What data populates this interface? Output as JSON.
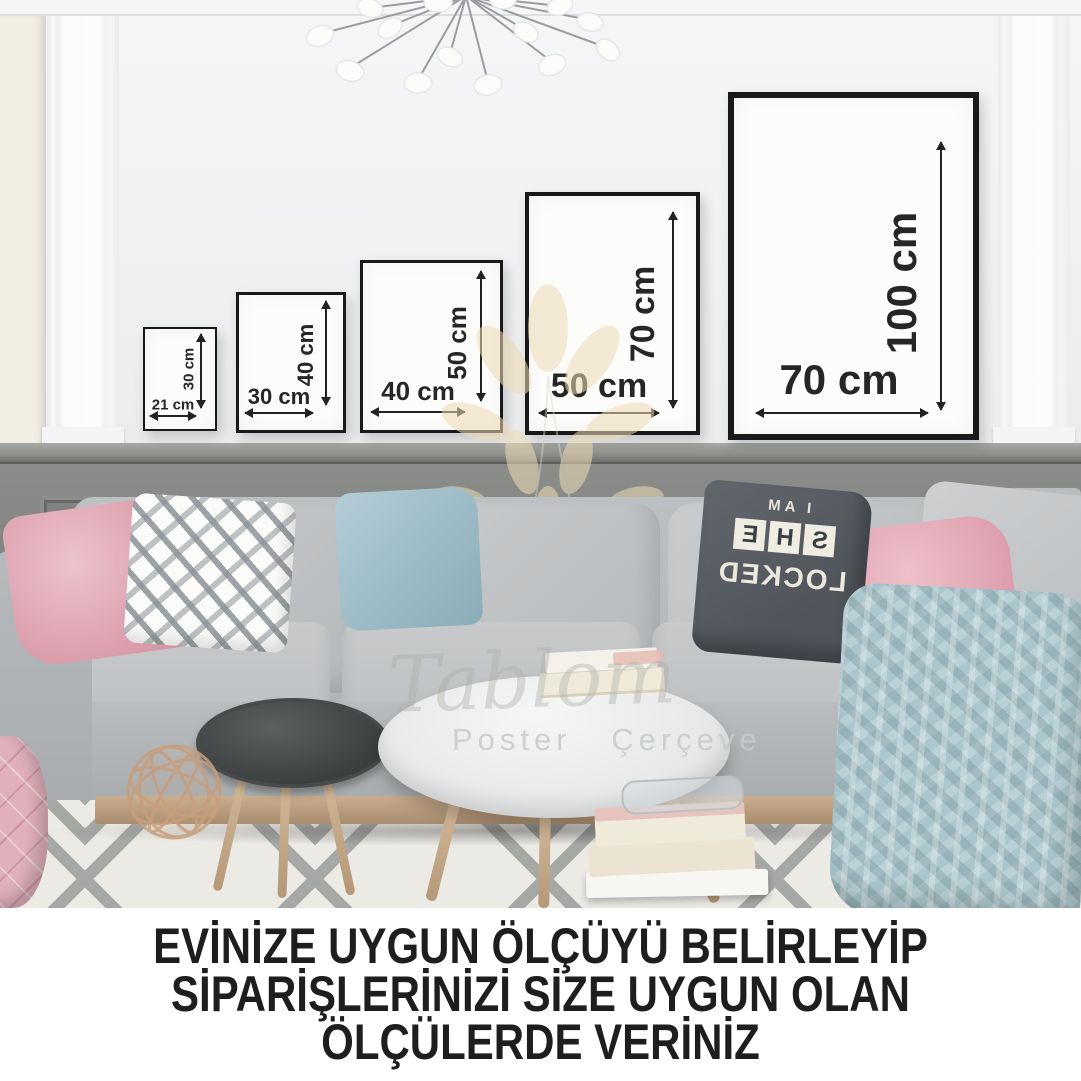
{
  "caption": {
    "line1": "EVİNİZE UYGUN ÖLÇÜYÜ BELİRLEYİP",
    "line2": "SİPARİŞLERİNİZİ SİZE UYGUN OLAN",
    "line3": "ÖLÇÜLERDE VERİNİZ"
  },
  "frames": [
    {
      "name": "21x30",
      "width_label": "21 cm",
      "height_label": "30 cm"
    },
    {
      "name": "30x40",
      "width_label": "30 cm",
      "height_label": "40 cm"
    },
    {
      "name": "40x50",
      "width_label": "40 cm",
      "height_label": "50 cm"
    },
    {
      "name": "50x70",
      "width_label": "50 cm",
      "height_label": "70 cm"
    },
    {
      "name": "70x100",
      "width_label": "70 cm",
      "height_label": "100 cm"
    }
  ],
  "watermark": {
    "brand_script": "Tablom",
    "subtitle": "Poster Çerçeve"
  },
  "pillow_print": {
    "top": "I AM",
    "she_letters": [
      "S",
      "H",
      "E"
    ],
    "bottom": "LOCKED"
  },
  "palette": {
    "frame_border": "#191919",
    "dimension_text": "#262626",
    "caption_text": "#1e1e1e",
    "wall": "#f0f1f2",
    "wainscot": "#82857f",
    "sofa": "#bcbfc1",
    "rug_pattern": "#a6a8a5",
    "accent_pink": "#dda2af",
    "accent_blue": "#abc7cd",
    "wood": "#c0a383",
    "watermark_tan": "#eedcb6"
  }
}
